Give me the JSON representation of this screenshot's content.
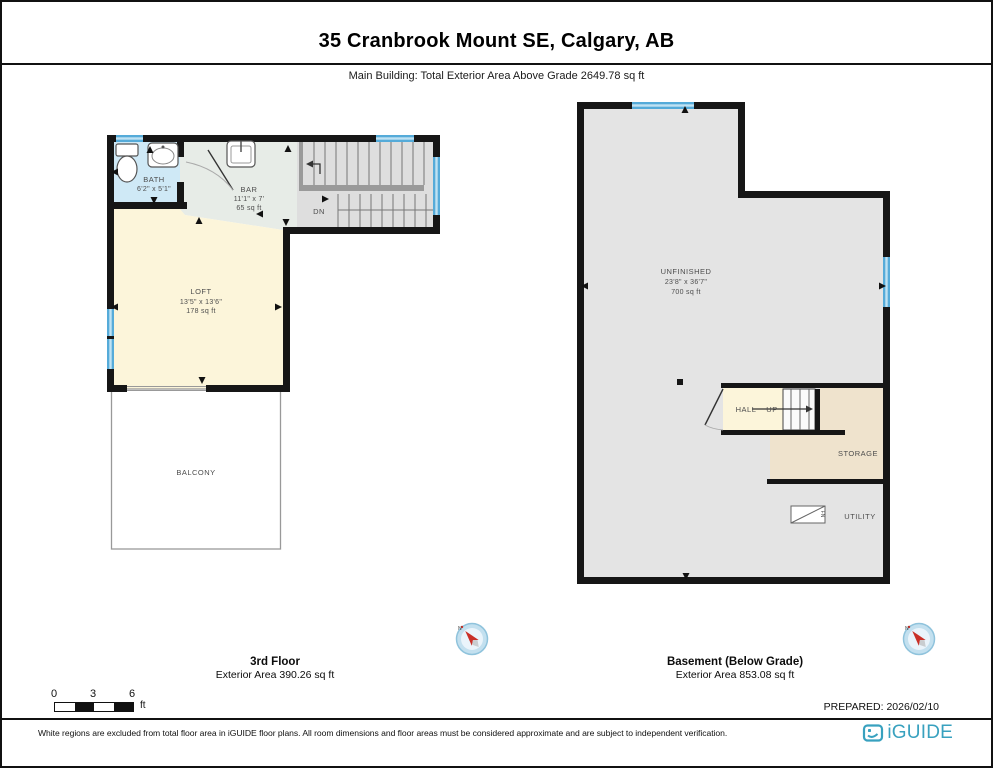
{
  "header": {
    "title": "35 Cranbrook Mount SE, Calgary, AB",
    "subtitle": "Main Building: Total Exterior Area Above Grade 2649.78 sq ft"
  },
  "plans": {
    "third": {
      "floor_name": "3rd Floor",
      "floor_area": "Exterior Area 390.26 sq ft",
      "bath": {
        "name": "BATH",
        "dims": "6'2\" x 5'1\""
      },
      "bar": {
        "name": "BAR",
        "dims": "11'1\" x 7'",
        "area": "65 sq ft"
      },
      "loft": {
        "name": "LOFT",
        "dims": "13'5\" x 13'6\"",
        "area": "178 sq ft"
      },
      "balcony": {
        "name": "BALCONY"
      },
      "stairs": {
        "down": "DN"
      }
    },
    "basement": {
      "floor_name": "Basement (Below Grade)",
      "floor_area": "Exterior Area 853.08 sq ft",
      "unfinished": {
        "name": "UNFINISHED",
        "dims": "23'8\" x 36'7\"",
        "area": "700 sq ft"
      },
      "hall": {
        "name": "HALL",
        "up": "UP"
      },
      "storage": {
        "name": "STORAGE"
      },
      "utility": {
        "name": "UTILITY",
        "furnace": "FN"
      }
    }
  },
  "scale_bar": {
    "tick0": "0",
    "tick1": "3",
    "tick2": "6",
    "unit": "ft"
  },
  "footer": {
    "prepared": "PREPARED: 2026/02/10",
    "disclaimer": "White regions are excluded from total floor area in iGUIDE floor plans. All room dimensions and floor areas must be considered approximate and are subject to independent verification.",
    "brand": "iGUIDE"
  },
  "colors": {
    "wall": "#161616",
    "window_blue": "#55abd9",
    "bath_blue": "#cfe9f6",
    "loft_cream": "#fcf5da",
    "storage_beige": "#efe3cd",
    "floor_grey": "#e4e4e4",
    "bar_grey_green": "#e7ece7",
    "brand_teal": "#38a1bf",
    "compass_red": "#c93028"
  }
}
